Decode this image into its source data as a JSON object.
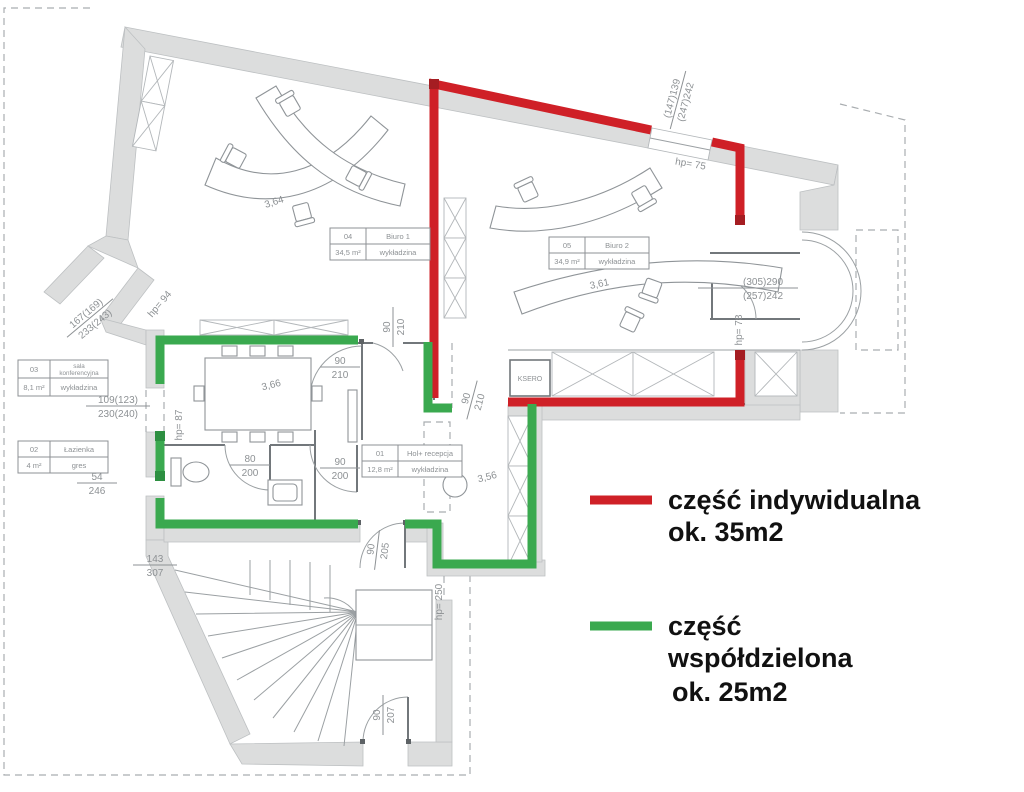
{
  "legend": {
    "individual": {
      "line1": "część indywidualna",
      "line2": "ok. 35m2",
      "color": "#cf2027"
    },
    "shared": {
      "line1": "część",
      "line2": "współdzielona",
      "line3": "ok. 25m2",
      "color": "#3aa94f"
    }
  },
  "rooms": {
    "hol": {
      "id": "01",
      "name": "Hol+ recepcja",
      "area": "12,8 m²",
      "floor": "wykładzina"
    },
    "lazienka": {
      "id": "02",
      "name": "Łazienka",
      "area": "4 m²",
      "floor": "gres"
    },
    "sala": {
      "id": "03",
      "name_line1": "sala",
      "name_line2": "konferencyjna",
      "area": "8,1 m²",
      "floor": "wykładzina"
    },
    "biuro1": {
      "id": "04",
      "name": "Biuro 1",
      "area": "34,5 m²",
      "floor": "wykładzina"
    },
    "biuro2": {
      "id": "05",
      "name": "Biuro 2",
      "area": "34,9 m²",
      "floor": "wykładzina"
    }
  },
  "labels": {
    "ksero": "KSERO",
    "diag_biuro1": "3,64",
    "diag_sala": "3,66",
    "diag_biuro2": "3,61",
    "diag_hol": "3,56"
  },
  "dims": {
    "d90_210": {
      "top": "90",
      "bottom": "210"
    },
    "d90_200": {
      "top": "90",
      "bottom": "200"
    },
    "d80_200": {
      "top": "80",
      "bottom": "200"
    },
    "d90_205": {
      "top": "90",
      "bottom": "205"
    },
    "d90_207": {
      "top": "90",
      "bottom": "207"
    },
    "d54_246": {
      "top": "54",
      "bottom": "246"
    },
    "d109_230": {
      "top": "109(123)",
      "bottom": "230(240)"
    },
    "d143_307": {
      "top": "143",
      "bottom": "307"
    },
    "d147_247": {
      "top": "(147)139",
      "bottom": "(247)242"
    },
    "d305_257": {
      "top": "(305)290",
      "bottom": "(257)242"
    },
    "d167_233": {
      "top": "167(169)",
      "bottom": "233(243)"
    },
    "hp75": "hp= 75",
    "hp78": "hp= 78",
    "hp87": "hp= 87",
    "hp94": "hp= 94",
    "hp250": "hp= 250"
  }
}
